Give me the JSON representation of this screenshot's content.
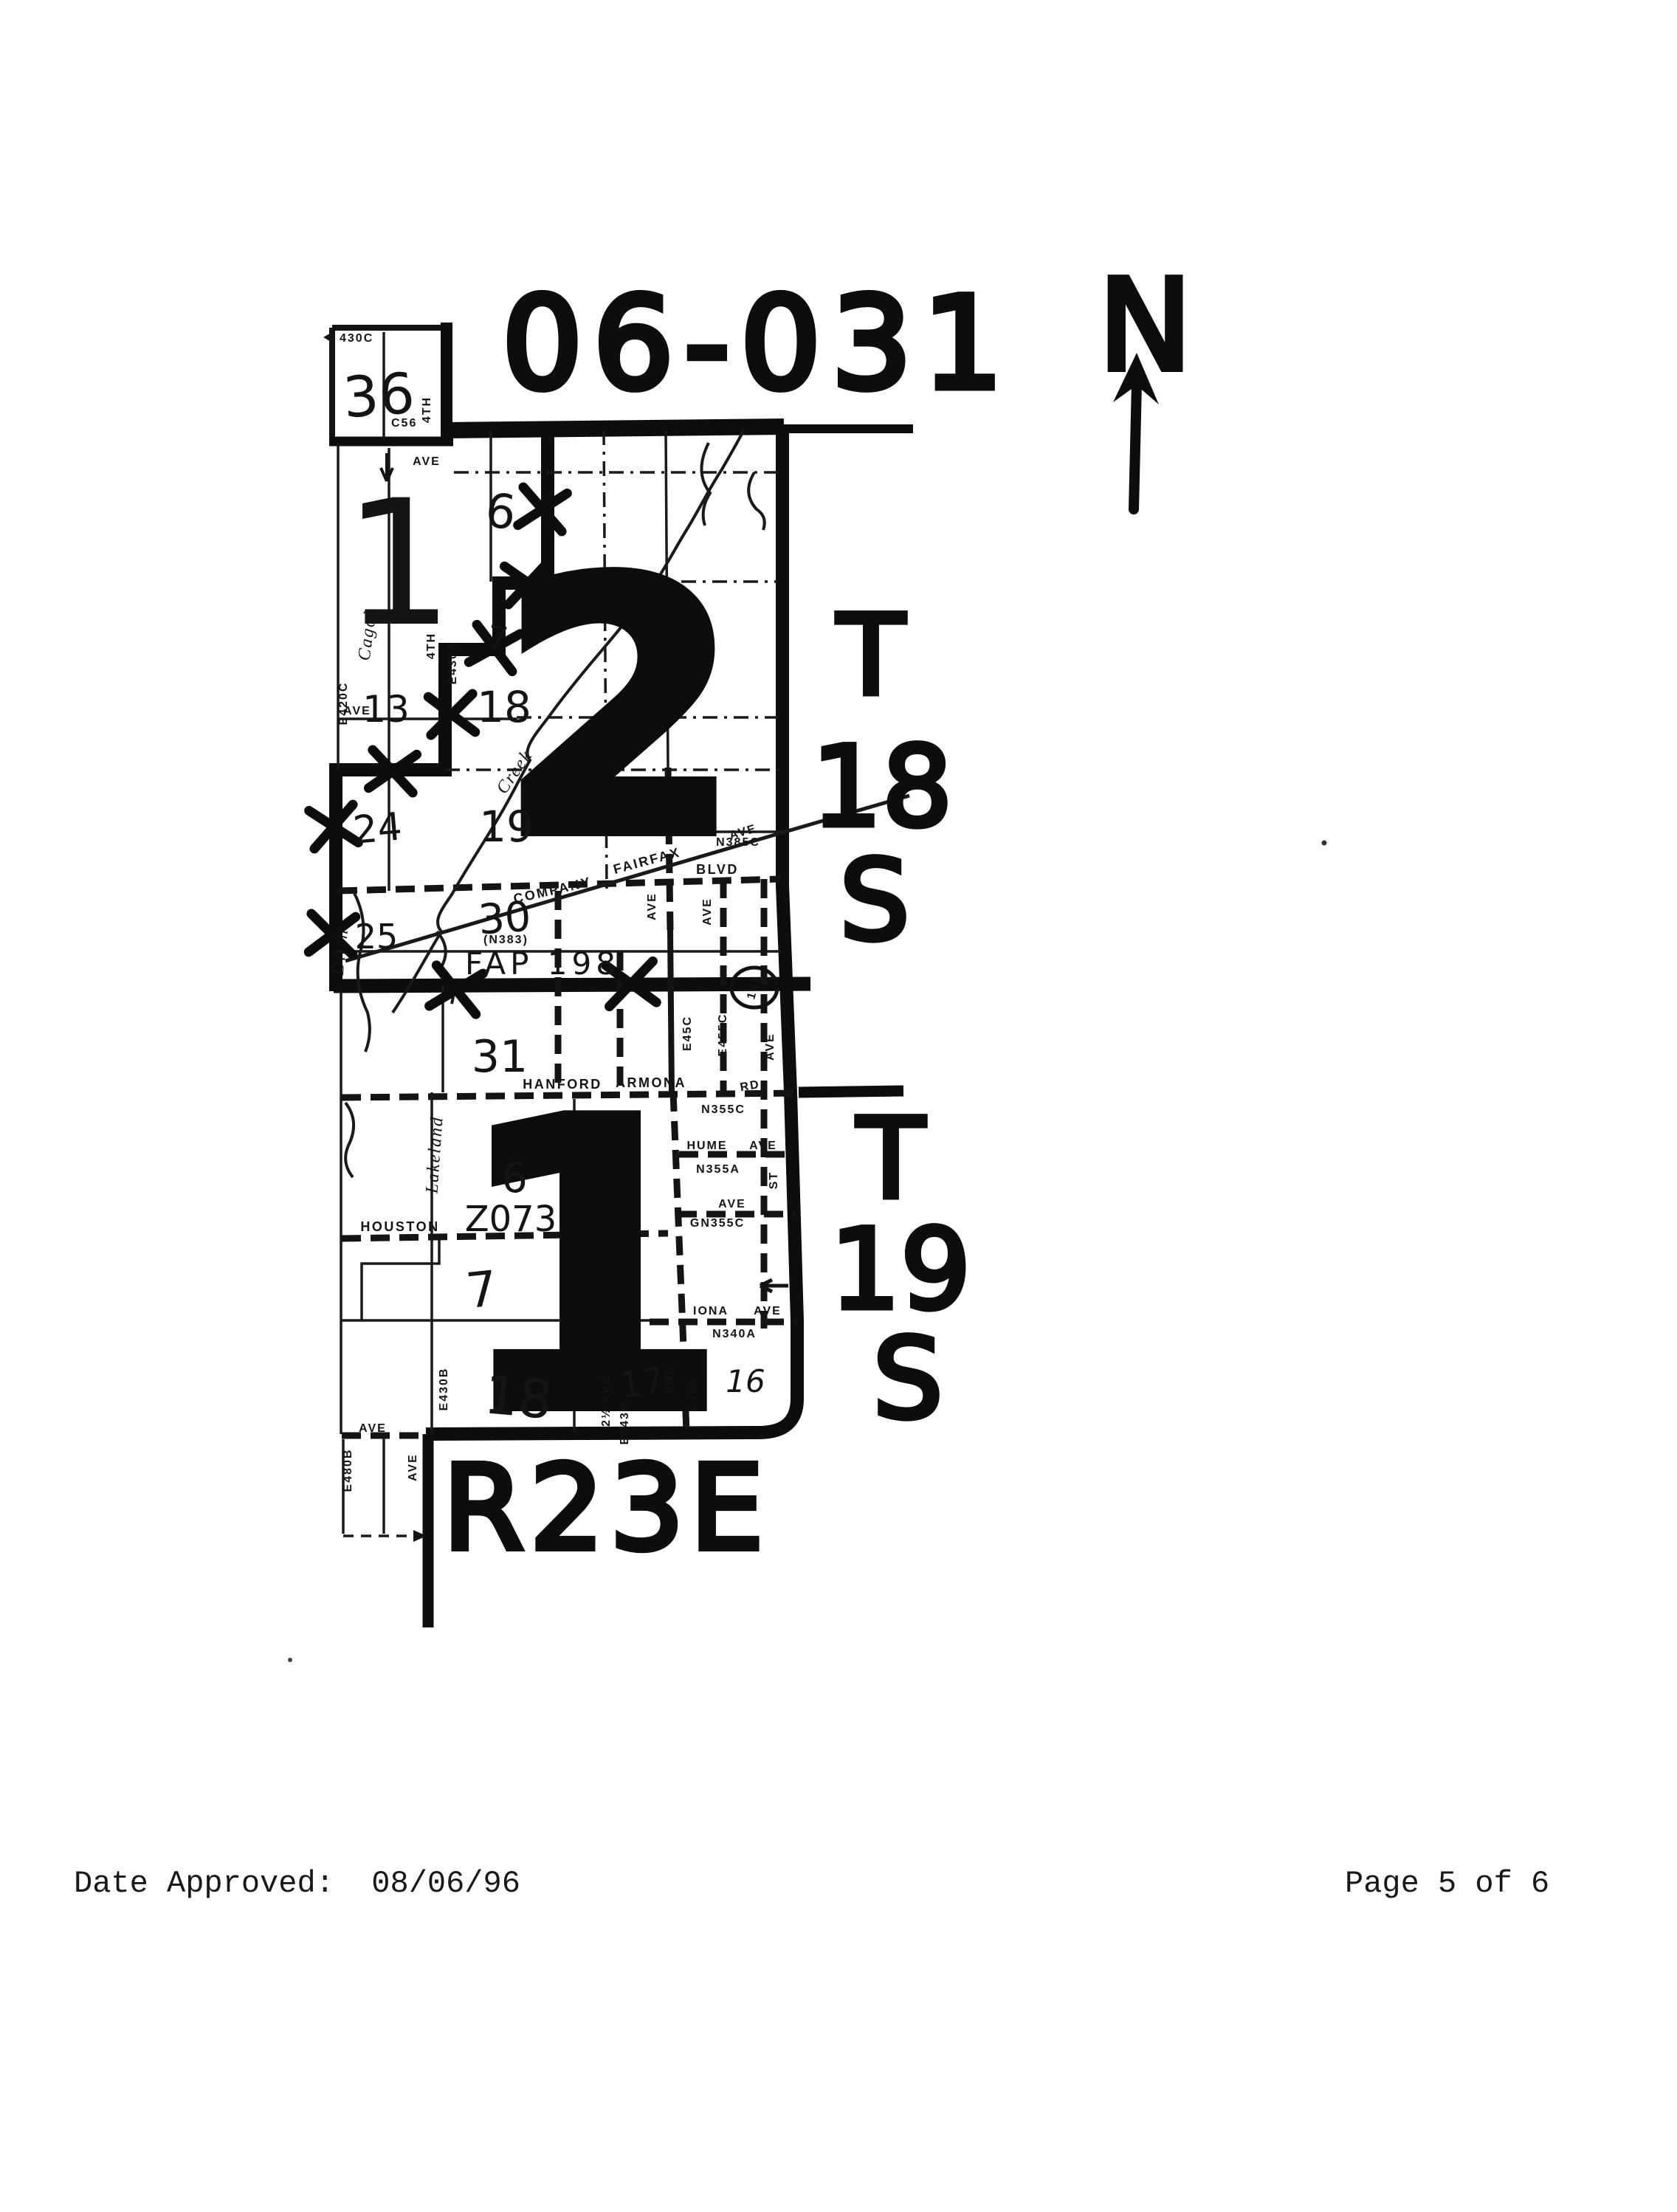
{
  "header": {
    "district_code": "06-031",
    "north_label": "N"
  },
  "footer": {
    "date_approved_label": "Date Approved:",
    "date_approved_value": "08/06/96",
    "page_info": "Page 5 of 6"
  },
  "map": {
    "range_label": "R23E",
    "township_upper": {
      "t": "T",
      "num": "18",
      "s": "S"
    },
    "township_lower": {
      "t": "T",
      "num": "19",
      "s": "S"
    },
    "districts": {
      "upper_big": "2",
      "lower_big": "1",
      "zone_code": "Z073"
    },
    "highway": {
      "fap": "FAP  198",
      "shield": "198"
    },
    "sections": {
      "s36": "36",
      "s1": "1",
      "s6_upper": "6",
      "s7_upper": "7",
      "s13": "13",
      "s18_upper": "18",
      "s24": "24",
      "s19": "19",
      "s25": "25",
      "s30": "30",
      "s31": "31",
      "s6_lower": "6",
      "s7_lower": "7",
      "s18_lower": "18",
      "s17": "17",
      "s16": "16"
    },
    "codes": {
      "c430c": "430C",
      "c56": "C56",
      "e420c": "E420C",
      "e430a": "E430A",
      "e430b": "E430B",
      "e443b": "E443B",
      "l450": "L450",
      "e455c": "E455C",
      "e45c": "E45C",
      "e480b": "E480B",
      "n340a": "N340A",
      "n355a": "N355A",
      "n355c": "N355C",
      "gn355c": "GN355C",
      "n383": "(N383)",
      "n385c": "N385C"
    },
    "roads": {
      "fourth": "4TH",
      "ave": "AVE",
      "blvd": "BLVD",
      "rd": "RD",
      "st": "ST",
      "second": "2ND",
      "two_half": "2½ AVE",
      "company": "COMPANY",
      "fairfax": "FAIRFAX",
      "hanford": "HANFORD",
      "armona": "ARMONA",
      "hume": "HUME",
      "houston": "HOUSTON",
      "iona": "IONA",
      "cagol": "Cagol",
      "lakeland": "Lakeland",
      "ditch": "Ditch",
      "creek": "Creek"
    }
  }
}
